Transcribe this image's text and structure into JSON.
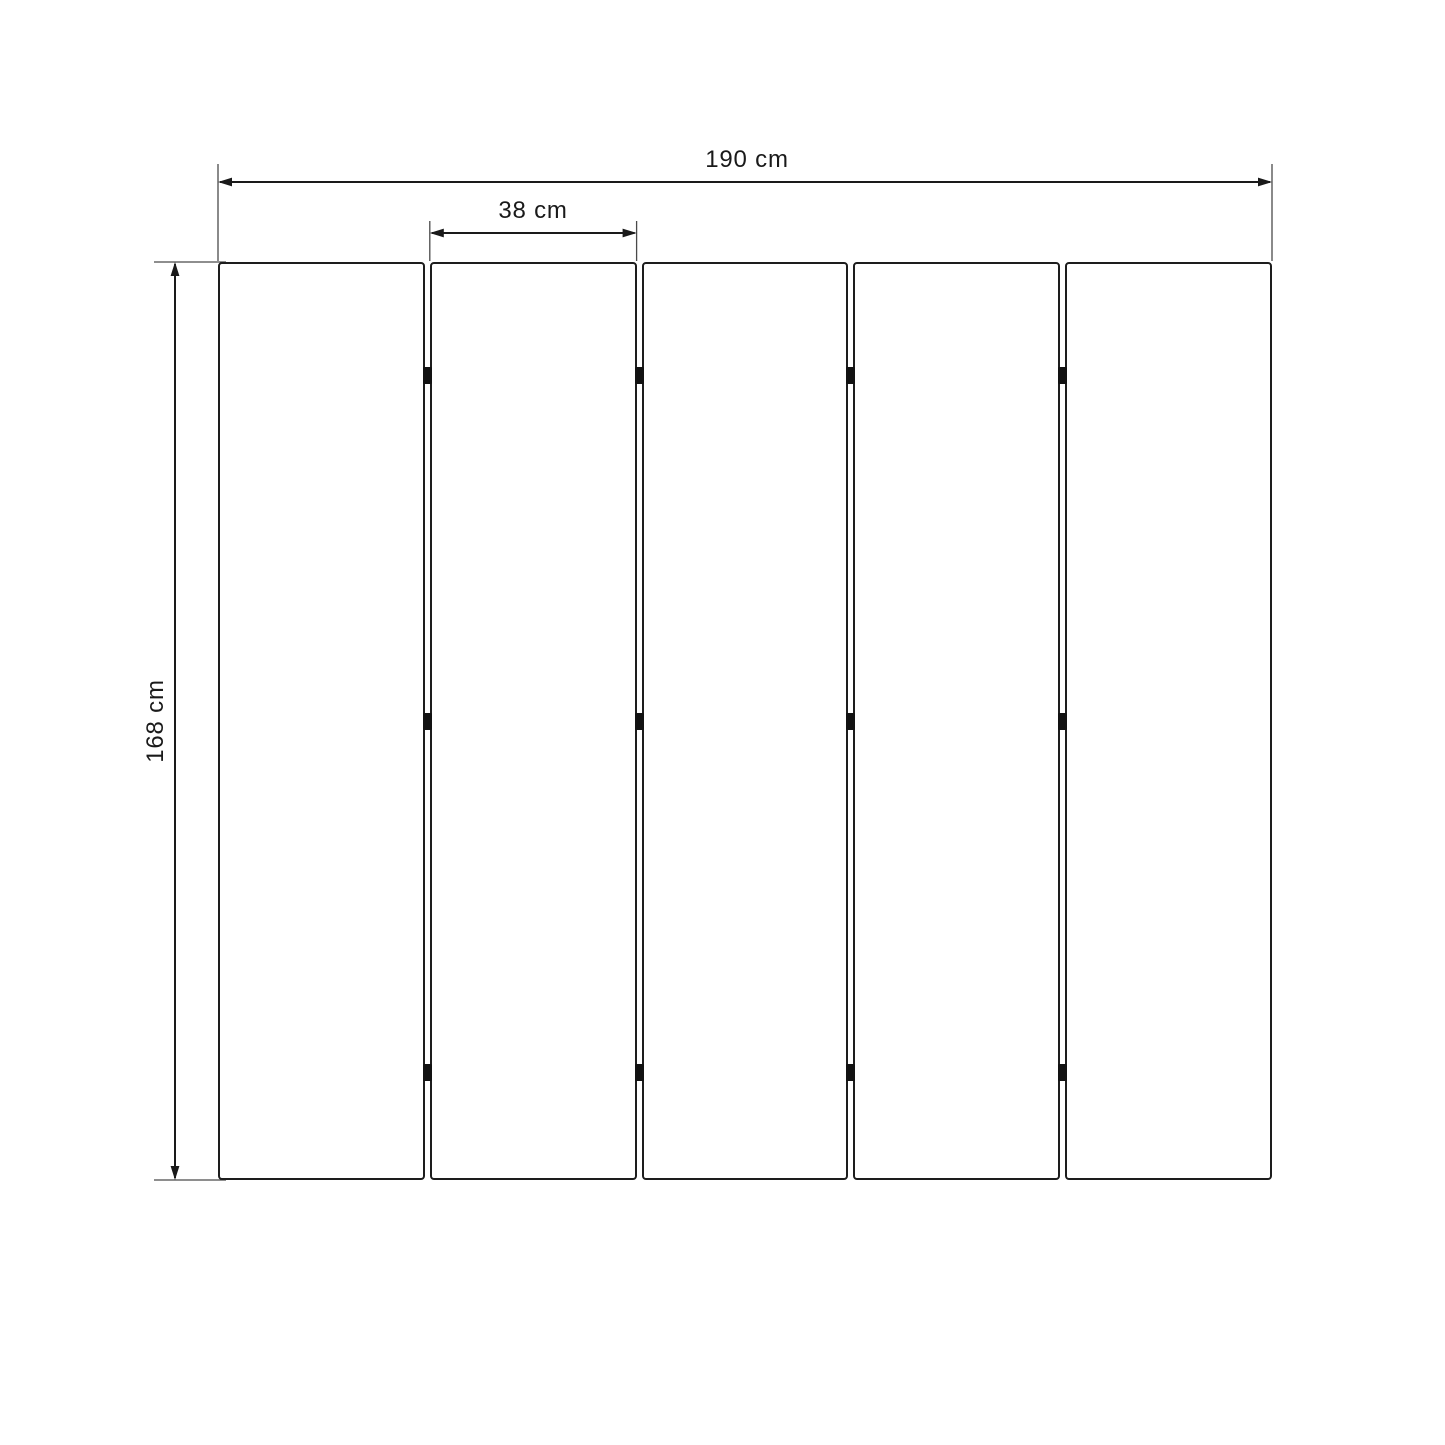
{
  "diagram": {
    "title": "five-panel-folding-screen-dimension-drawing",
    "panel_count": 5,
    "gap_count": 4,
    "hinge_rows_per_gap": 3,
    "labels": {
      "total_width": "190 cm",
      "panel_width": "38 cm",
      "height": "168 cm"
    },
    "colors": {
      "line": "#1a1a1a",
      "extension_line": "#4a4a4a",
      "hinge": "#121212",
      "background": "#ffffff"
    }
  }
}
